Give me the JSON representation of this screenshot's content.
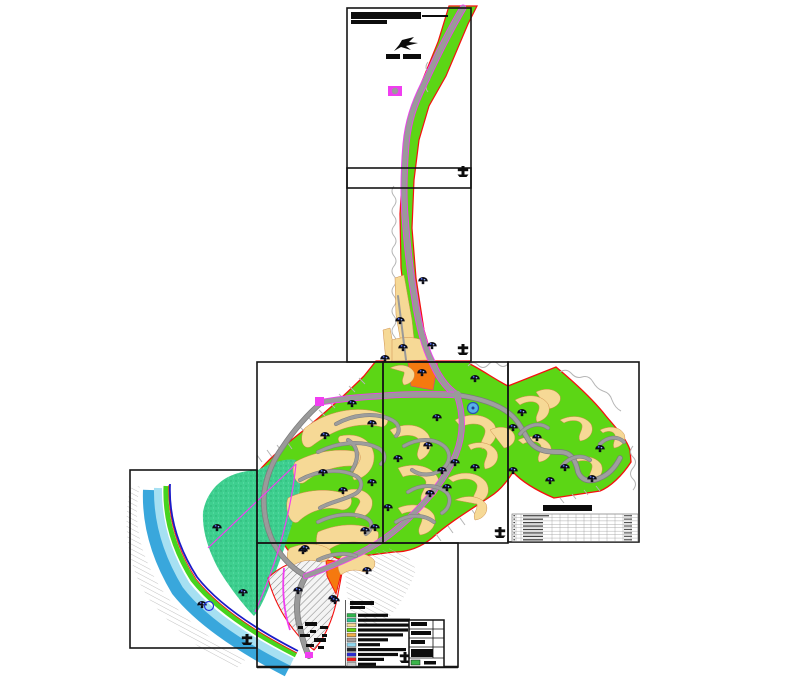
{
  "sheet": {
    "kind": "cad-zoning-site-plan",
    "background": "#ffffff",
    "text_note": "all annotation text rendered below legibility threshold"
  },
  "palette": {
    "park_green": "#5cd615",
    "buffer_teal": "#3ecf8f",
    "residential_tan": "#f6d996",
    "public_orange": "#f5790f",
    "road_gray": "#9a9a9a",
    "road_casing": "#7d7d7d",
    "road_magenta": "#f03ef0",
    "boundary_red": "#f50f0f",
    "river_blue": "#39a7dc",
    "river_shallow": "#a6e0f2",
    "shore_green": "#46d41e",
    "water_line": "#1b1bc8",
    "frame_black": "#151515",
    "contour_gray": "#b5b5b5",
    "pond_blue": "#57b0e8"
  },
  "legend": {
    "title_bar_widths": [
      24,
      15
    ],
    "entries": [
      {
        "swatch": "#2fb34c",
        "bar_w": 30
      },
      {
        "swatch": "#2ec491",
        "bar_w": 52
      },
      {
        "swatch": "#f6d996",
        "bar_w": 55
      },
      {
        "swatch": "#63d912",
        "bar_w": 50
      },
      {
        "swatch": "#f2b04a",
        "bar_w": 45
      },
      {
        "swatch": "#a0a0a0",
        "bar_w": 30
      },
      {
        "swatch": "#8fd8f0",
        "bar_w": 22
      },
      {
        "swatch": "#222228",
        "bar_w": 48
      },
      {
        "swatch": "#2b2bd0",
        "bar_w": 40
      },
      {
        "swatch": "#ee1c1c",
        "bar_w": 26
      },
      {
        "swatch": "#c8c8c8",
        "bar_w": 18
      }
    ]
  },
  "summary_table": {
    "title_bar_w": 49,
    "rows": 8,
    "col_xs": [
      516,
      521,
      552,
      560,
      568,
      576,
      584,
      591,
      599,
      607,
      615,
      623,
      631
    ],
    "x": 512,
    "y": 514,
    "w": 126,
    "h": 27.5
  },
  "title_block": {
    "row_bar_widths": [
      16,
      20,
      14
    ],
    "swatch": "#3bb54a"
  },
  "map": {
    "trees": [
      [
        423,
        280
      ],
      [
        400,
        320
      ],
      [
        432,
        345
      ],
      [
        403,
        347
      ],
      [
        385,
        358
      ],
      [
        422,
        372
      ],
      [
        475,
        378
      ],
      [
        352,
        403
      ],
      [
        372,
        423
      ],
      [
        437,
        417
      ],
      [
        325,
        435
      ],
      [
        428,
        445
      ],
      [
        398,
        458
      ],
      [
        455,
        462
      ],
      [
        442,
        470
      ],
      [
        475,
        467
      ],
      [
        323,
        472
      ],
      [
        372,
        482
      ],
      [
        447,
        487
      ],
      [
        430,
        493
      ],
      [
        343,
        490
      ],
      [
        388,
        507
      ],
      [
        365,
        530
      ],
      [
        522,
        412
      ],
      [
        513,
        427
      ],
      [
        537,
        437
      ],
      [
        600,
        448
      ],
      [
        565,
        467
      ],
      [
        592,
        478
      ],
      [
        513,
        470
      ],
      [
        550,
        480
      ],
      [
        217,
        527
      ],
      [
        243,
        592
      ],
      [
        202,
        604
      ],
      [
        303,
        550
      ],
      [
        367,
        570
      ],
      [
        333,
        598
      ],
      [
        375,
        527
      ],
      [
        305,
        548
      ],
      [
        298,
        590
      ],
      [
        335,
        600
      ]
    ],
    "survey_crosses": [
      [
        463,
        174
      ],
      [
        463,
        352
      ],
      [
        500,
        535
      ],
      [
        627,
        536
      ],
      [
        247,
        642
      ],
      [
        405,
        660
      ]
    ],
    "pond": {
      "x": 473,
      "y": 408,
      "r": 5.5
    }
  }
}
